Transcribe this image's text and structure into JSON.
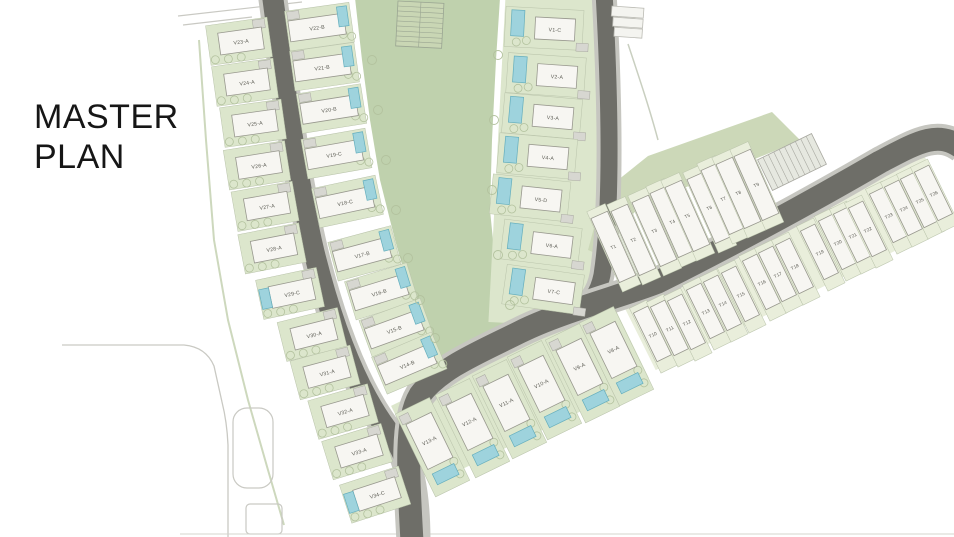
{
  "title": {
    "line1": "MASTER",
    "line2": "PLAN"
  },
  "colors": {
    "park": "#bfd1ad",
    "plotGreen": "#dce6cc",
    "paleGreen": "#e9eedb",
    "bandGreen": "#ccd8b8",
    "road": "#6e6e68",
    "roadEdge": "#c6c6c0",
    "building": "#f7f6f2",
    "buildingStroke": "#98988e",
    "pool": "#9ed3dd",
    "poolStroke": "#64aebd",
    "hatch": "#d7d7d1",
    "hatchStroke": "#a8a8a0",
    "label": "#5a5a52",
    "outline": "#c9c9c3",
    "tree": "#b3c29e",
    "title": "#161616"
  },
  "plan": {
    "kinds": {
      "vl": {
        "name": "villa-lot",
        "plotFill": "plotGreen",
        "plot": [
          -33,
          -20,
          62,
          40
        ],
        "bld": [
          -22,
          -11,
          44,
          22
        ],
        "pool": false,
        "poolRect": [
          -32,
          -10,
          10,
          20
        ],
        "hatch": [
          14,
          -19,
          12,
          9
        ],
        "label": [
          0,
          1
        ],
        "fs": 5.2,
        "trees": [
          [
            -28,
            15
          ],
          [
            -15,
            16
          ],
          [
            -2,
            16
          ]
        ]
      },
      "vm": {
        "name": "villa-lot",
        "plotFill": "plotGreen",
        "plot": [
          -30,
          -20,
          65,
          40
        ],
        "bld": [
          -28,
          -10,
          56,
          21
        ],
        "pool": true,
        "poolRect": [
          22,
          -17,
          10,
          20
        ],
        "hatch": [
          -28,
          -19,
          12,
          8
        ],
        "label": [
          0,
          1
        ],
        "fs": 5.2,
        "trees": [
          [
            25,
            11
          ],
          [
            33,
            14
          ]
        ]
      },
      "vr": {
        "name": "villa-lot",
        "plotFill": "plotGreen",
        "plot": [
          -50,
          -20,
          78,
          40
        ],
        "bld": [
          -20,
          -11,
          40,
          22
        ],
        "pool": true,
        "poolRect": [
          -44,
          -17,
          13,
          26
        ],
        "hatch": [
          22,
          13,
          12,
          8
        ],
        "label": [
          0,
          1
        ],
        "fs": 5.2,
        "trees": [
          [
            -28,
            13
          ],
          [
            -38,
            15
          ]
        ]
      },
      "vb": {
        "name": "villa-lot",
        "plotFill": "plotGreen",
        "plot": [
          -19,
          -38,
          38,
          92
        ],
        "bld": [
          -14,
          -24,
          28,
          50
        ],
        "pool": true,
        "poolRect": [
          -12,
          32,
          24,
          12
        ],
        "hatch": [
          -17,
          -34,
          10,
          9
        ],
        "label": [
          0,
          1
        ],
        "fs": 5.2,
        "trees": [
          [
            13,
            30
          ],
          [
            13,
            44
          ]
        ]
      },
      "th": {
        "name": "townhouse-lot",
        "plotFill": "paleGreen",
        "plot": [
          -9.5,
          -32,
          19,
          72
        ],
        "bld": [
          -8,
          -26,
          16,
          54
        ],
        "pool": false,
        "label": [
          0,
          2
        ],
        "fs": 4.6,
        "trees": []
      },
      "tc": {
        "name": "townhouse-lot",
        "plotFill": "paleGreen",
        "plot": [
          -10,
          -42,
          20,
          88
        ],
        "bld": [
          -9,
          -34,
          18,
          70
        ],
        "pool": false,
        "label": [
          0,
          1
        ],
        "fs": 4.6,
        "trees": []
      }
    },
    "units": [
      {
        "id": "V23-A",
        "x": 241,
        "y": 41,
        "r": -8,
        "k": "vl"
      },
      {
        "id": "V24-A",
        "x": 247,
        "y": 82,
        "r": -8,
        "k": "vl"
      },
      {
        "id": "V25-A",
        "x": 255,
        "y": 123,
        "r": -8,
        "k": "vl"
      },
      {
        "id": "V26-A",
        "x": 259,
        "y": 165,
        "r": -9,
        "k": "vl"
      },
      {
        "id": "V27-A",
        "x": 267,
        "y": 206,
        "r": -10,
        "k": "vl"
      },
      {
        "id": "V28-A",
        "x": 274,
        "y": 248,
        "r": -11,
        "k": "vl"
      },
      {
        "id": "V29-C",
        "x": 292,
        "y": 293,
        "r": -12,
        "k": "vl",
        "pool": true
      },
      {
        "id": "V30-A",
        "x": 314,
        "y": 334,
        "r": -14,
        "k": "vl"
      },
      {
        "id": "V31-A",
        "x": 327,
        "y": 372,
        "r": -15,
        "k": "vl"
      },
      {
        "id": "V32-A",
        "x": 345,
        "y": 411,
        "r": -16,
        "k": "vl"
      },
      {
        "id": "V33-A",
        "x": 359,
        "y": 451,
        "r": -17,
        "k": "vl"
      },
      {
        "id": "V34-C",
        "x": 377,
        "y": 494,
        "r": -18,
        "k": "vl",
        "pool": true
      },
      {
        "id": "V22-B",
        "x": 317,
        "y": 27,
        "r": -8,
        "k": "vm"
      },
      {
        "id": "V21-B",
        "x": 322,
        "y": 67,
        "r": -8,
        "k": "vm"
      },
      {
        "id": "V20-B",
        "x": 329,
        "y": 109,
        "r": -9,
        "k": "vm"
      },
      {
        "id": "V19-C",
        "x": 334,
        "y": 154,
        "r": -10,
        "k": "vm"
      },
      {
        "id": "V18-C",
        "x": 345,
        "y": 202,
        "r": -12,
        "k": "vm"
      },
      {
        "id": "V17-B",
        "x": 362,
        "y": 254,
        "r": -15,
        "k": "vm"
      },
      {
        "id": "V16-B",
        "x": 379,
        "y": 292,
        "r": -17,
        "k": "vm"
      },
      {
        "id": "V15-B",
        "x": 394,
        "y": 329,
        "r": -20,
        "k": "vm"
      },
      {
        "id": "V14-B",
        "x": 407,
        "y": 364,
        "r": -23,
        "k": "vm"
      },
      {
        "id": "V1-C",
        "x": 555,
        "y": 29,
        "r": 3,
        "k": "vr"
      },
      {
        "id": "V2-A",
        "x": 557,
        "y": 76,
        "r": 4,
        "k": "vr"
      },
      {
        "id": "V3-A",
        "x": 553,
        "y": 117,
        "r": 5,
        "k": "vr"
      },
      {
        "id": "V4-A",
        "x": 548,
        "y": 157,
        "r": 5,
        "k": "vr"
      },
      {
        "id": "V5-D",
        "x": 541,
        "y": 199,
        "r": 6,
        "k": "vr"
      },
      {
        "id": "V6-A",
        "x": 552,
        "y": 245,
        "r": 7,
        "k": "vr"
      },
      {
        "id": "V7-C",
        "x": 554,
        "y": 291,
        "r": 8,
        "k": "vr"
      },
      {
        "id": "V13-A",
        "x": 429,
        "y": 440,
        "r": -26,
        "k": "vb"
      },
      {
        "id": "V12-A",
        "x": 469,
        "y": 421,
        "r": -26,
        "k": "vb"
      },
      {
        "id": "V11-A",
        "x": 506,
        "y": 402,
        "r": -26,
        "k": "vb"
      },
      {
        "id": "V10-A",
        "x": 541,
        "y": 383,
        "r": -26,
        "k": "vb"
      },
      {
        "id": "V9-A",
        "x": 579,
        "y": 366,
        "r": -26,
        "k": "vb"
      },
      {
        "id": "V8-A",
        "x": 613,
        "y": 349,
        "r": -26,
        "k": "vb"
      },
      {
        "id": "T10",
        "x": 652,
        "y": 333,
        "r": -26,
        "k": "th"
      },
      {
        "id": "T11",
        "x": 669,
        "y": 327,
        "r": -26,
        "k": "th"
      },
      {
        "id": "T12",
        "x": 686,
        "y": 321,
        "r": -26,
        "k": "th"
      },
      {
        "id": "T13",
        "x": 705,
        "y": 310,
        "r": -26,
        "k": "th"
      },
      {
        "id": "T14",
        "x": 722,
        "y": 302,
        "r": -26,
        "k": "th"
      },
      {
        "id": "T15",
        "x": 740,
        "y": 293,
        "r": -26,
        "k": "th"
      },
      {
        "id": "T16",
        "x": 761,
        "y": 281,
        "r": -26,
        "k": "th"
      },
      {
        "id": "T17",
        "x": 777,
        "y": 273,
        "r": -26,
        "k": "th"
      },
      {
        "id": "T18",
        "x": 794,
        "y": 265,
        "r": -26,
        "k": "th"
      },
      {
        "id": "T19",
        "x": 819,
        "y": 251,
        "r": -26,
        "k": "th"
      },
      {
        "id": "T20",
        "x": 837,
        "y": 241,
        "r": -26,
        "k": "th"
      },
      {
        "id": "T21",
        "x": 852,
        "y": 234,
        "r": -26,
        "k": "th"
      },
      {
        "id": "T22",
        "x": 867,
        "y": 228,
        "r": -26,
        "k": "th"
      },
      {
        "id": "T23",
        "x": 888,
        "y": 214,
        "r": -26,
        "k": "th"
      },
      {
        "id": "T24",
        "x": 903,
        "y": 207,
        "r": -26,
        "k": "th"
      },
      {
        "id": "T25",
        "x": 919,
        "y": 199,
        "r": -26,
        "k": "th"
      },
      {
        "id": "T26",
        "x": 933,
        "y": 192,
        "r": -26,
        "k": "th"
      },
      {
        "id": "T1",
        "x": 613,
        "y": 246,
        "r": -24,
        "k": "tc"
      },
      {
        "id": "T2",
        "x": 633,
        "y": 239,
        "r": -24,
        "k": "tc"
      },
      {
        "id": "T3",
        "x": 654,
        "y": 230,
        "r": -24,
        "k": "tc"
      },
      {
        "id": "T4",
        "x": 672,
        "y": 221,
        "r": -24,
        "k": "tc"
      },
      {
        "id": "T5",
        "x": 687,
        "y": 215,
        "r": -24,
        "k": "tc"
      },
      {
        "id": "T6",
        "x": 709,
        "y": 207,
        "r": -24,
        "k": "tc"
      },
      {
        "id": "T7",
        "x": 723,
        "y": 198,
        "r": -24,
        "k": "tc"
      },
      {
        "id": "T8",
        "x": 738,
        "y": 192,
        "r": -24,
        "k": "tc"
      },
      {
        "id": "T9",
        "x": 756,
        "y": 184,
        "r": -24,
        "k": "tc"
      }
    ],
    "park_trees": [
      [
        372,
        60
      ],
      [
        378,
        110
      ],
      [
        386,
        160
      ],
      [
        396,
        210
      ],
      [
        408,
        258
      ],
      [
        420,
        300
      ],
      [
        435,
        338
      ],
      [
        498,
        55
      ],
      [
        494,
        120
      ],
      [
        492,
        190
      ],
      [
        498,
        255
      ],
      [
        510,
        305
      ]
    ]
  }
}
